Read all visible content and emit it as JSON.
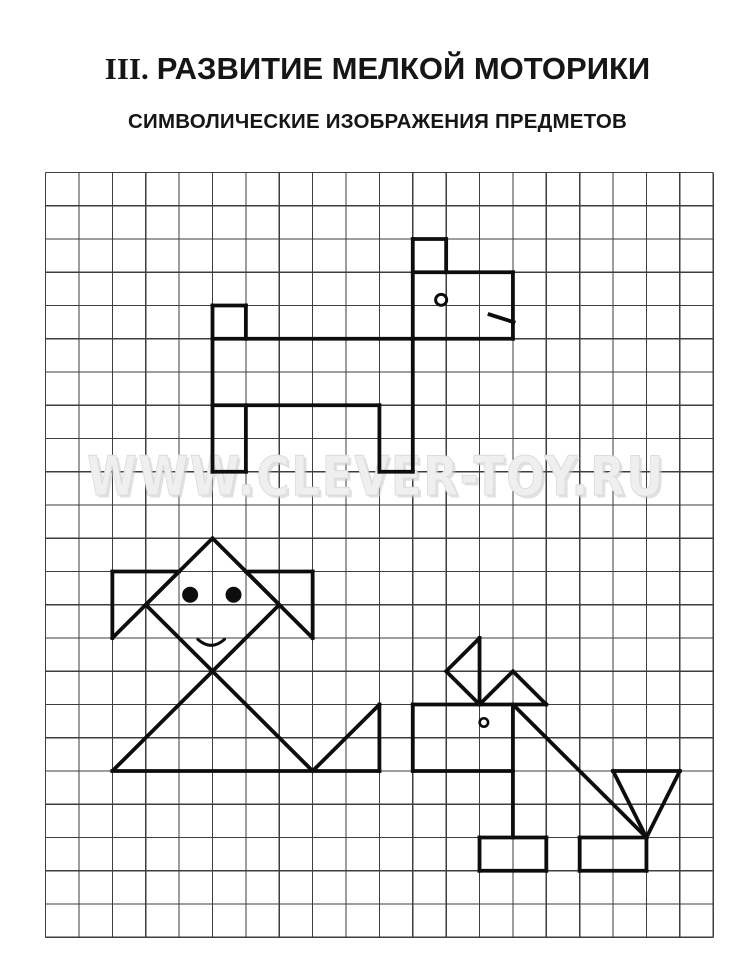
{
  "page": {
    "title_prefix": "III.",
    "title": "РАЗВИТИЕ МЕЛКОЙ МОТОРИКИ",
    "subtitle": "СИМВОЛИЧЕСКИЕ ИЗОБРАЖЕНИЯ ПРЕДМЕТОВ"
  },
  "watermark": {
    "text": "WWW.CLEVER-TOY.RU"
  },
  "colors": {
    "paper": "#ffffff",
    "heading_text": "#161616",
    "grid_line": "#3e3e3e",
    "figure_ink": "#0d0d0d",
    "watermark_fill": "#efefef",
    "watermark_outline": "#dcdcdc",
    "watermark_shadow": "#c9c9c9"
  },
  "grid": {
    "x": 45.6,
    "y": 172.5,
    "cols": 20,
    "rows": 23,
    "cell_w": 33.38,
    "cell_h": 33.25,
    "line_width": 1.2
  },
  "figures": [
    {
      "name": "dog",
      "stroke_width": 3.8,
      "segments": [
        [
          11,
          2,
          12,
          2
        ],
        [
          11,
          3,
          14,
          3
        ],
        [
          5,
          4,
          6,
          4
        ],
        [
          5,
          5,
          14,
          5
        ],
        [
          5,
          7,
          10,
          7
        ],
        [
          5,
          9,
          6,
          9
        ],
        [
          10,
          9,
          11,
          9
        ],
        [
          11,
          2,
          11,
          9
        ],
        [
          12,
          2,
          12,
          3
        ],
        [
          14,
          3,
          14,
          5
        ],
        [
          5,
          4,
          5,
          9
        ],
        [
          6,
          4,
          6,
          5
        ],
        [
          6,
          7,
          6,
          9
        ],
        [
          10,
          7,
          10,
          9
        ],
        [
          13.3,
          4.27,
          14.02,
          4.5
        ]
      ],
      "circles": [
        {
          "col": 11.85,
          "row": 3.83,
          "radius": 5.5,
          "stroke_width": 3,
          "filled": false
        }
      ],
      "curves": []
    },
    {
      "name": "girl",
      "stroke_width": 3.8,
      "segments": [
        [
          5,
          11,
          3,
          13
        ],
        [
          5,
          11,
          7,
          13
        ],
        [
          3,
          13,
          8,
          18
        ],
        [
          7,
          13,
          2,
          18
        ],
        [
          2,
          12,
          4,
          12
        ],
        [
          2,
          12,
          2,
          14
        ],
        [
          2,
          14,
          4,
          12
        ],
        [
          6,
          12,
          8,
          12
        ],
        [
          8,
          12,
          8,
          14
        ],
        [
          6,
          12,
          8,
          14
        ],
        [
          2,
          18,
          10,
          18
        ],
        [
          8,
          18,
          10,
          16
        ],
        [
          10,
          16,
          10,
          18
        ]
      ],
      "circles": [
        {
          "col": 4.33,
          "row": 12.7,
          "radius": 7,
          "stroke_width": 2,
          "filled": true
        },
        {
          "col": 5.63,
          "row": 12.7,
          "radius": 7,
          "stroke_width": 2,
          "filled": true
        }
      ],
      "curves": [
        {
          "type": "smile",
          "stroke_width": 3,
          "pts": [
            [
              4.56,
              14.04
            ],
            [
              4.97,
              14.4
            ],
            [
              5.36,
              14.04
            ]
          ]
        }
      ]
    },
    {
      "name": "puppy",
      "stroke_width": 3.8,
      "segments": [
        [
          13,
          14,
          13,
          16
        ],
        [
          13,
          14,
          12,
          15
        ],
        [
          12,
          15,
          13,
          16
        ],
        [
          14,
          15,
          13,
          16
        ],
        [
          14,
          15,
          15,
          16
        ],
        [
          11,
          16,
          15,
          16
        ],
        [
          11,
          16,
          11,
          18
        ],
        [
          11,
          18,
          14,
          18
        ],
        [
          14,
          16,
          14,
          20
        ],
        [
          14,
          16,
          18,
          20
        ],
        [
          17,
          18,
          19,
          18
        ],
        [
          17,
          18,
          18,
          20
        ],
        [
          19,
          18,
          18,
          20
        ],
        [
          13,
          20,
          15,
          20
        ],
        [
          13,
          21,
          15,
          21
        ],
        [
          13,
          20,
          13,
          21
        ],
        [
          15,
          20,
          15,
          21
        ],
        [
          16,
          20,
          18,
          20
        ],
        [
          16,
          21,
          18,
          21
        ],
        [
          16,
          20,
          16,
          21
        ],
        [
          18,
          20,
          18,
          21
        ]
      ],
      "circles": [
        {
          "col": 13.13,
          "row": 16.54,
          "radius": 4.2,
          "stroke_width": 2.6,
          "filled": false
        }
      ],
      "curves": []
    }
  ]
}
